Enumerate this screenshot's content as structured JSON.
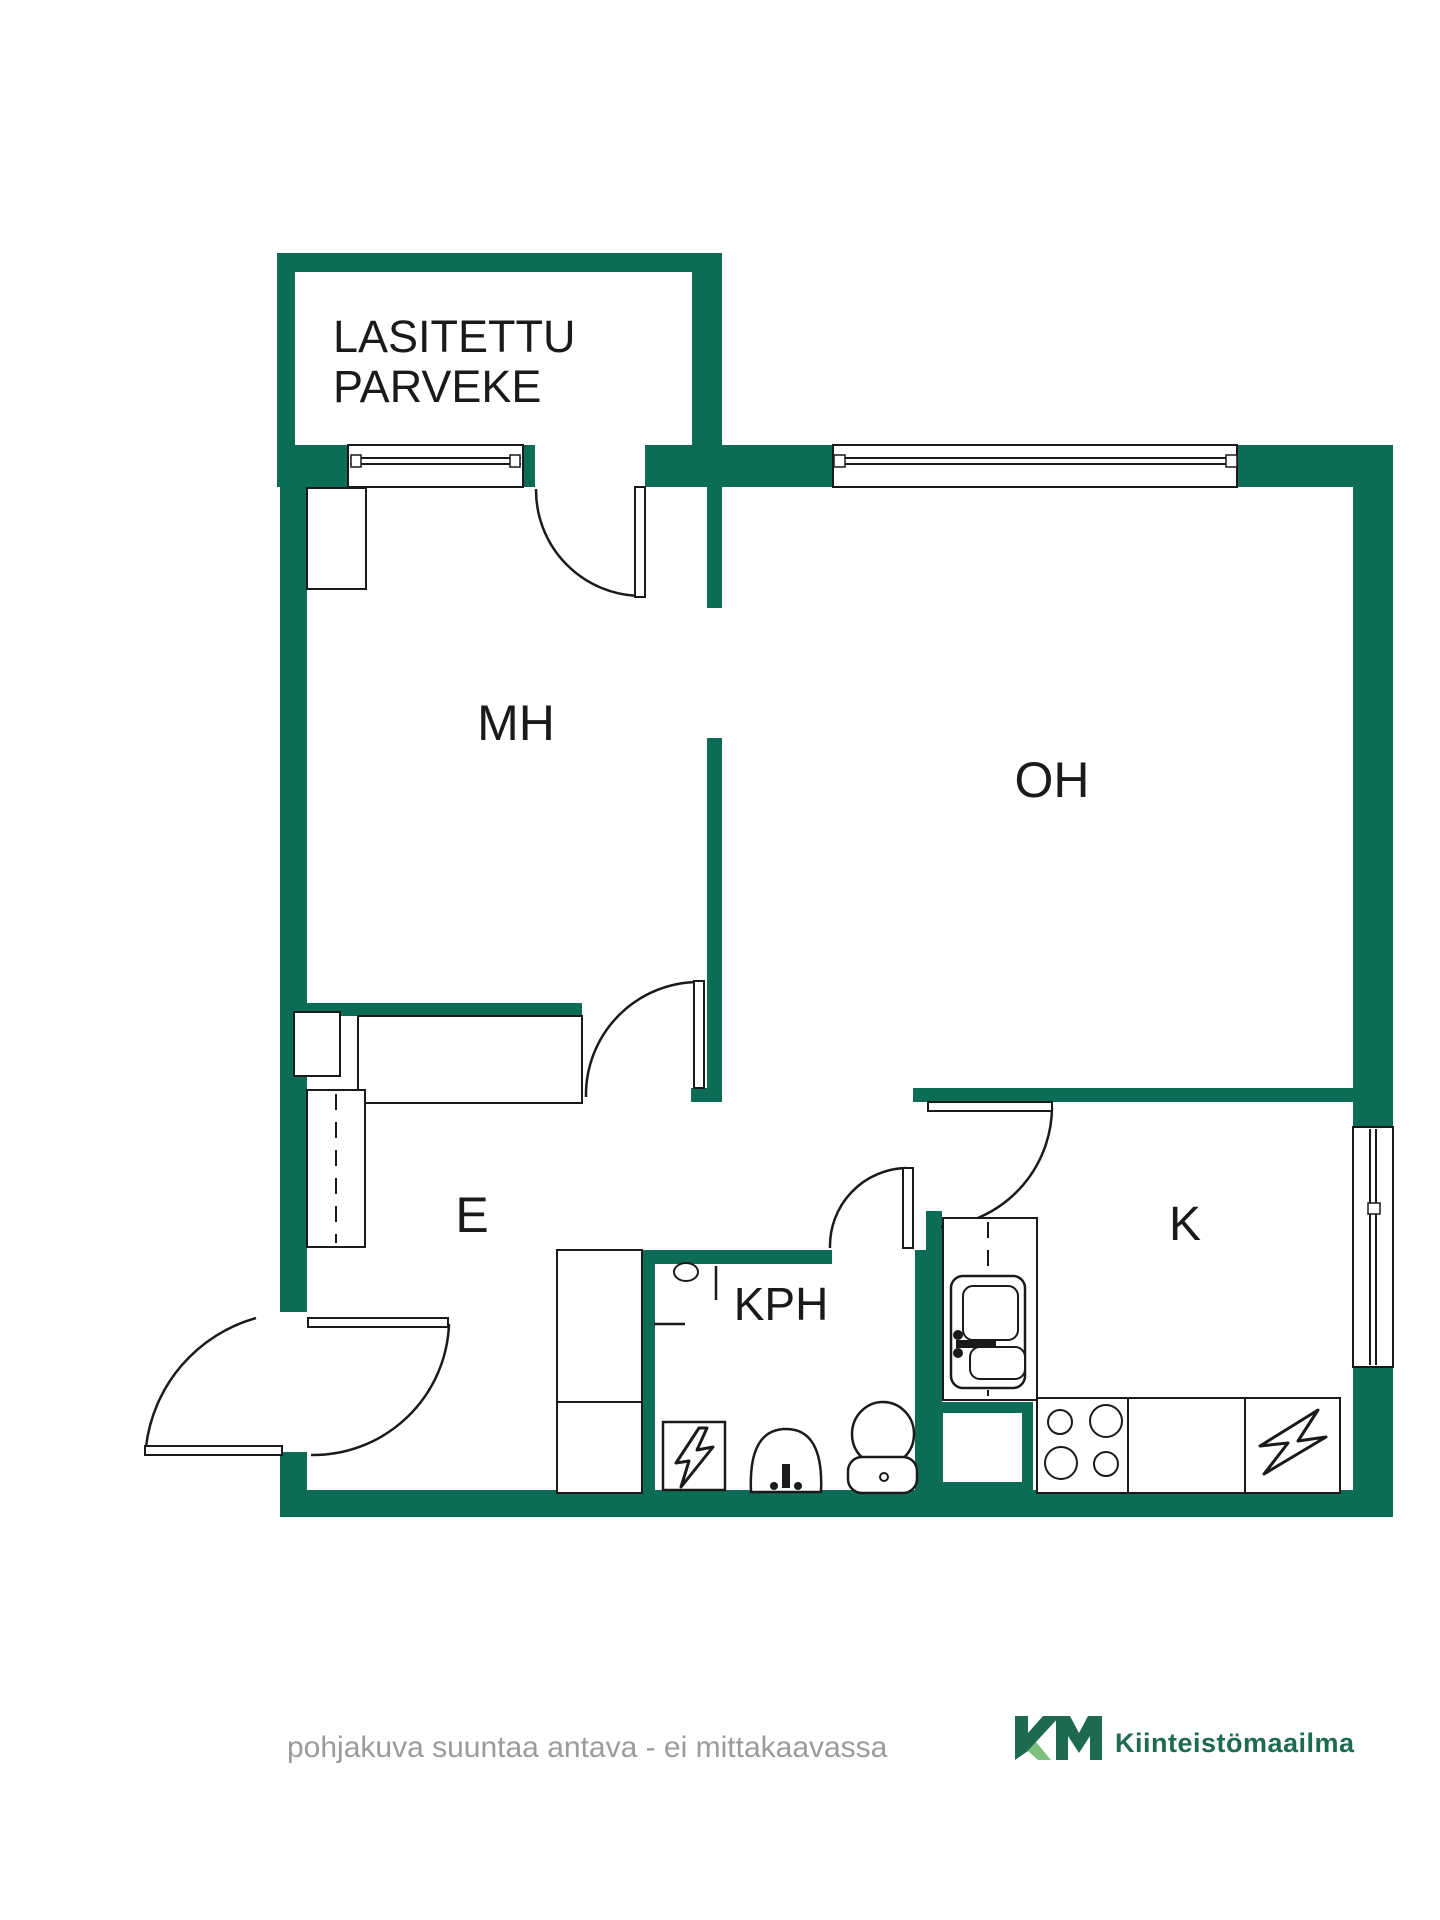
{
  "colors": {
    "wall": "#0d6c56",
    "line": "#1a1a1a",
    "caption": "#9b9b9b",
    "logo_dark": "#1e6a4f",
    "logo_light": "#7cc07f"
  },
  "plan": {
    "balcony_label_line1": "LASITETTU",
    "balcony_label_line2": "PARVEKE",
    "rooms": {
      "bedroom": "MH",
      "living_room": "OH",
      "entry": "E",
      "bathroom": "KPH",
      "kitchen": "K"
    }
  },
  "footer": {
    "disclaimer": "pohjakuva suuntaa antava - ei mittakaavassa",
    "brand_name": "Kiinteistömaailma"
  }
}
